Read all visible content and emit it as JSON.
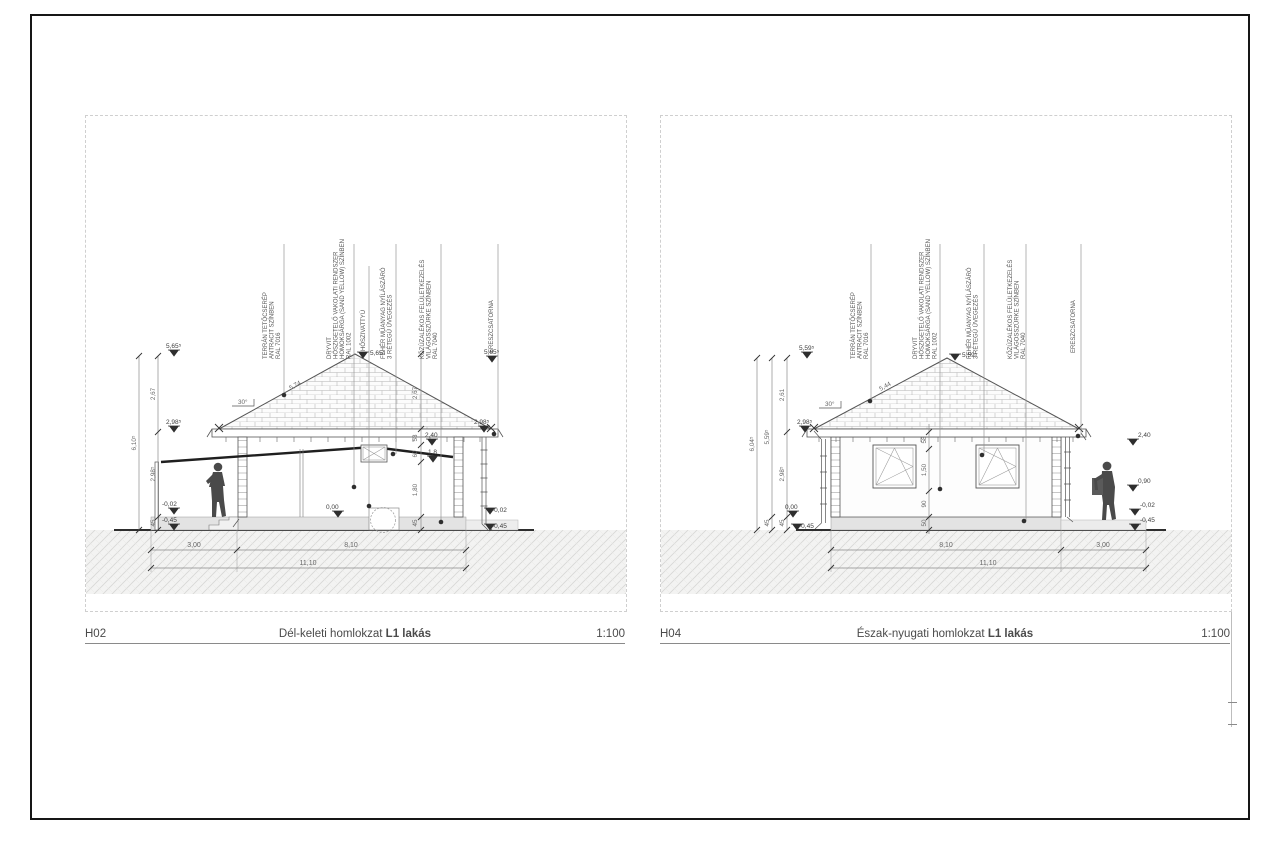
{
  "sheet": {
    "bg": "#ffffff",
    "border_color": "#161616",
    "accent_red": "#b58383"
  },
  "drawings": [
    {
      "code": "H02",
      "title": "Dél-keleti homlokzat",
      "title_suffix": "L1 lakás",
      "scale": "1:100",
      "slope": "30°",
      "rafter_length": "5,74",
      "annotations": [
        {
          "lines": [
            "TERRÁN TETŐCSERÉP",
            "ANTRACIT SZÍNBEN",
            "RAL 7016"
          ]
        },
        {
          "lines": [
            "DRYVIT",
            "HŐSZIGETELŐ VAKOLATI RENDSZER",
            "HOMOKSÁRGA (SAND YELLOW) SZÍNBEN",
            "RAL 1002"
          ]
        },
        {
          "lines": [
            "HŐSZIVATTYÚ"
          ]
        },
        {
          "lines": [
            "FEHÉR MŰANYAG NYÍLÁSZÁRÓ",
            "3 RÉTEGŰ ÜVEGEZÉS"
          ]
        },
        {
          "lines": [
            "KŐZÚZALÉKOS FELÜLETKEZELÉS",
            "VILÁGOSSZÜRKE SZÍNBEN",
            "RAL 7040"
          ]
        },
        {
          "lines": [
            "ERESZCSATORNA"
          ]
        }
      ],
      "levels": {
        "ridge": "5,65⁵",
        "eaves": "2,98⁵",
        "zero": "0,00",
        "minus02": "-0,02",
        "minus45": "-0,45",
        "lintel": "2,40",
        "sill": "1,8"
      },
      "vdims": {
        "overall": "6,10⁵",
        "roof": "2,67",
        "wall": "2,98⁵",
        "plinth": "45"
      },
      "chain": [
        "2,67",
        "58",
        "60",
        "1,80",
        "45"
      ],
      "hdims": {
        "d1": "3,00",
        "d2": "8,10",
        "total": "11,10"
      }
    },
    {
      "code": "H04",
      "title": "Észak-nyugati homlokzat",
      "title_suffix": "L1 lakás",
      "scale": "1:100",
      "slope": "30°",
      "rafter_length": "5,44",
      "annotations": [
        {
          "lines": [
            "TERRÁN TETŐCSERÉP",
            "ANTRACIT SZÍNBEN",
            "RAL 7016"
          ]
        },
        {
          "lines": [
            "DRYVIT",
            "HŐSZIGETELŐ VAKOLATI RENDSZER",
            "HOMOKSÁRGA (SAND YELLOW) SZÍNBEN",
            "RAL 1002"
          ]
        },
        {
          "lines": [
            "FEHÉR MŰANYAG NYÍLÁSZÁRÓ",
            "3 RÉTEGŰ ÜVEGEZÉS"
          ]
        },
        {
          "lines": [
            "KŐZÚZALÉKOS FELÜLETKEZELÉS",
            "VILÁGOSSZÜRKE SZÍNBEN",
            "RAL 7040"
          ]
        },
        {
          "lines": [
            "ERESZCSATORNA"
          ]
        }
      ],
      "levels": {
        "ridge": "5,59⁵",
        "eaves": "2,98⁵",
        "zero": "0,00",
        "minus02": "-0,02",
        "minus45": "-0,45",
        "lintel": "2,40",
        "sill": "0,90"
      },
      "vdims": {
        "overall": "6,04⁵",
        "second": "5,59⁵",
        "roof": "2,61",
        "wall": "2,98⁵",
        "plinth": "45",
        "plinth2": "45"
      },
      "chain": [
        "58",
        "1,50",
        "90",
        "50"
      ],
      "hdims": {
        "d1": "8,10",
        "d2": "3,00",
        "total": "11,10"
      }
    }
  ]
}
